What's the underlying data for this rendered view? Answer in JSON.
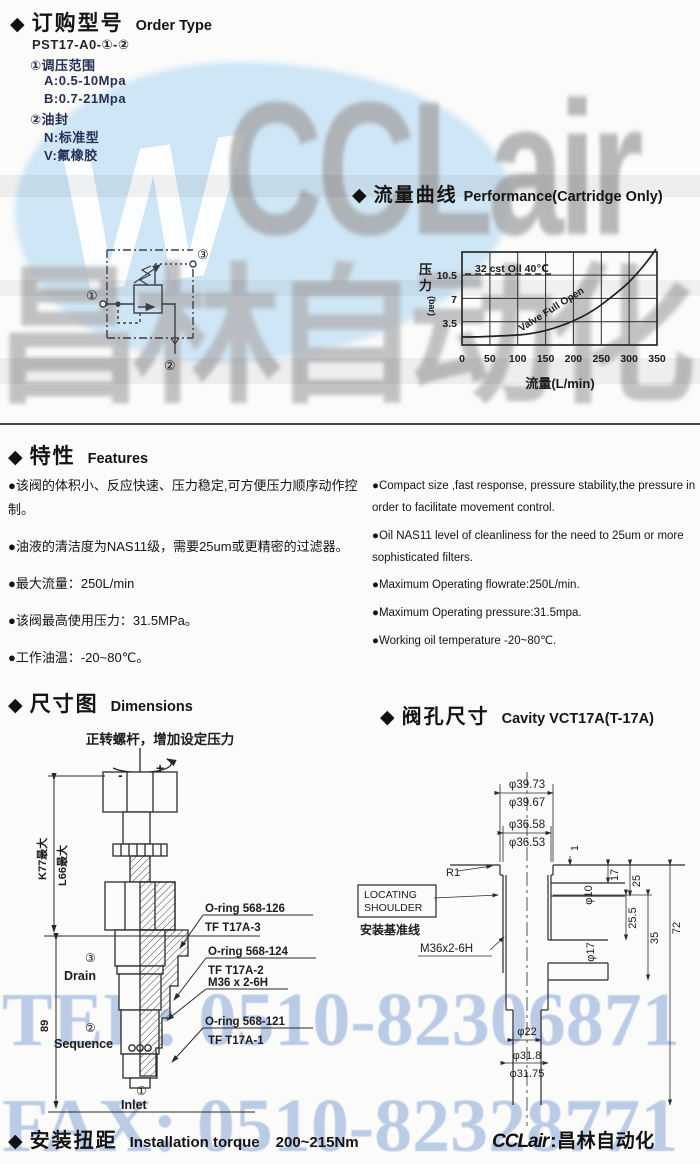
{
  "watermark": {
    "logo_mark": "W",
    "logo_text": "CCLair",
    "brand_cn": "昌林自动化",
    "tel": "TEL: 0510-82306871",
    "fax": "FAX: 0510-82328771",
    "colors": {
      "logo_bg": "#cfe6f6",
      "letters": "#a6a7a9",
      "telfax": "#b4c6e4"
    }
  },
  "order_type": {
    "bullet": "◆",
    "title_zh": "订购型号",
    "title_en": "Order Type",
    "model": "PST17-A0-①-②",
    "options": [
      "①调压范围",
      "A:0.5-10Mpa",
      "B:0.7-21Mpa",
      "②油封",
      "N:标准型",
      "V:氟橡胶"
    ]
  },
  "schematic": {
    "port1": "①",
    "port2": "②",
    "port3": "③"
  },
  "performance": {
    "bullet": "◆",
    "title_zh": "流量曲线",
    "title_en": "Performance(Cartridge Only)",
    "note": "32 cst Oil 40℃",
    "curve_label": "Valve Full Open",
    "y_char1": "压",
    "y_char2": "力",
    "y_unit": "(bar)",
    "x_axis_label": "流量(L/min)",
    "y_ticks": [
      "10.5",
      "7",
      "3.5"
    ],
    "x_ticks": [
      "0",
      "50",
      "100",
      "150",
      "200",
      "250",
      "300",
      "350"
    ]
  },
  "chart_data": {
    "type": "line",
    "title": "流量曲线 Performance(Cartridge Only)",
    "xlabel": "流量(L/min)",
    "ylabel": "压力(bar)",
    "xlim": [
      0,
      350
    ],
    "ylim": [
      0,
      14
    ],
    "x_ticks": [
      0,
      50,
      100,
      150,
      200,
      250,
      300,
      350
    ],
    "y_ticks": [
      3.5,
      7,
      10.5
    ],
    "grid": true,
    "legend_position": "none",
    "annotations": [
      "32 cst Oil 40℃",
      "Valve Full Open"
    ],
    "series": [
      {
        "name": "Valve Full Open",
        "x": [
          0,
          50,
          100,
          150,
          200,
          250,
          300,
          330,
          348
        ],
        "y": [
          1.2,
          1.3,
          1.5,
          2.2,
          3.6,
          6.0,
          9.5,
          12.3,
          14.0
        ]
      }
    ]
  },
  "features": {
    "bullet": "◆",
    "title_zh": "特性",
    "title_en": "Features",
    "zh": [
      "●该阀的体积小、反应快速、压力稳定,可方便压力顺序动作控制。",
      "●油液的清洁度为NAS11级，需要25um或更精密的过滤器。",
      "●最大流量：250L/min",
      "●该阀最高使用压力：31.5MPa。",
      "●工作油温：-20~80℃。"
    ],
    "en": [
      "●Compact size ,fast response, pressure stability,the pressure in order to facilitate movement control.",
      "●Oil NAS11 level of cleanliness for the need to 25um or more sophisticated filters.",
      "●Maximum Operating flowrate:250L/min.",
      "●Maximum  Operating pressure:31.5mpa.",
      "●Working oil temperature -20~80℃."
    ]
  },
  "dimensions": {
    "bullet": "◆",
    "title_zh": "尺寸图",
    "title_en": "Dimensions",
    "note": "正转螺杆，增加设定压力",
    "minus": "-",
    "plus": "+",
    "dim_k": "K77最大",
    "dim_l": "L66最大",
    "dim_total": "89",
    "port3_num": "③",
    "port3": "Drain",
    "port2_num": "②",
    "port2": "Sequence",
    "port1_num": "①",
    "port1": "Inlet",
    "callout1a": "O-ring 568-126",
    "callout1b": "TF T17A-3",
    "callout2a": "O-ring 568-124",
    "callout2b": "TF T17A-2",
    "callout3": "M36 x 2-6H",
    "callout4a": "O-ring 568-121",
    "callout4b": "TF T17A-1"
  },
  "cavity": {
    "bullet": "◆",
    "title_zh": "阀孔尺寸",
    "title_en": "Cavity VCT17A(T-17A)",
    "d1a": "φ39.73",
    "d1b": "φ39.67",
    "d2a": "φ36.58",
    "d2b": "φ36.53",
    "r1": "R1",
    "depth1": "1",
    "locating1": "LOCATING",
    "locating2": "SHOULDER",
    "datum": "安装基准线",
    "thread": "M36x2-6H",
    "d10": "φ10",
    "dim17": "17",
    "dim25": "25",
    "dim255": "25.5",
    "dim35": "35",
    "dim72": "72",
    "d17": "φ17",
    "d22": "φ22",
    "d318": "φ31.8",
    "d3175": "φ31.75"
  },
  "torque": {
    "bullet": "◆",
    "title_zh": "安装扭距",
    "title_en": "Installation torque",
    "value": "200~215Nm"
  },
  "footer": {
    "brand": "CCLair",
    "sep": ":",
    "company": "昌林自动化"
  }
}
